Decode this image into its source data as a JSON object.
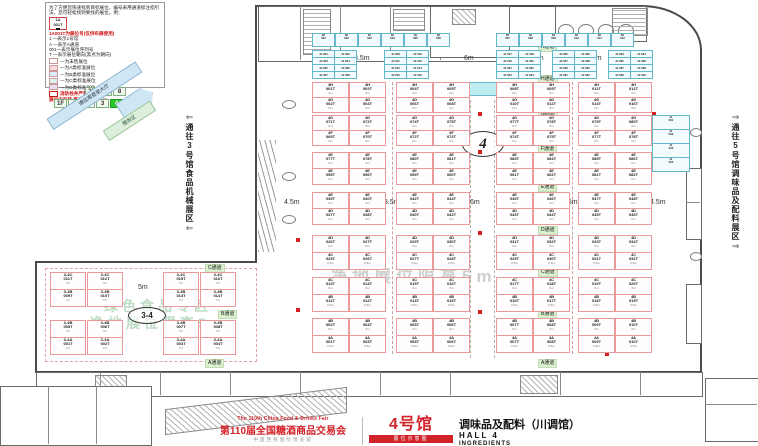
{
  "legend": {
    "intro": "为了方便您快速找到目标展位，编号采用通道标注指引法，您可轻松找到要找的展位。例：",
    "example": {
      "line1": "1A",
      "line2": "001T"
    },
    "red_note": "1A001T为展位号(仅供布展使用)",
    "key_lines": [
      "1 —表示1号馆",
      "A —表示A通道",
      "001—表示展位序列号",
      "T —表示展位朝向(黑点为朝向)"
    ],
    "swatches": [
      {
        "color": "#ffffff",
        "label": "—为未售展位"
      },
      {
        "color": "#f9d9dc",
        "label": "—为A类标准展位"
      },
      {
        "color": "#d9ecf9",
        "label": "—为B类标准展位"
      },
      {
        "color": "#d9f4ee",
        "label": "—为C类标准展位"
      },
      {
        "color": "#e6def2",
        "label": "—为D类标准展位"
      }
    ],
    "warn1": "消防栓井严禁遮挡",
    "warn2": "展位内安装 高度限制为1.5m"
  },
  "floor_selector": {
    "upper": [
      "2F",
      "7",
      "8"
    ],
    "lower": [
      "1F",
      "1",
      "2",
      "3",
      "4",
      "5",
      "6"
    ],
    "active": "4"
  },
  "diagonals": {
    "blue_band": "通往南登录大厅",
    "green_band": "服务区"
  },
  "passages": {
    "left": "通往3号馆食品机械展区",
    "right": "通往5号馆调味品及配料展区"
  },
  "markers": {
    "hall": "4",
    "annex": "3-4"
  },
  "watermarks": {
    "center": "净地展位限高5m",
    "annex_line1": "绿色食品专区",
    "annex_line2": "净地展位限高5m"
  },
  "aisle_labels": [
    {
      "t": "K通道",
      "x": 538,
      "y": 43
    },
    {
      "t": "H通道",
      "x": 538,
      "y": 75
    },
    {
      "t": "G通道",
      "x": 538,
      "y": 110
    },
    {
      "t": "F通道",
      "x": 538,
      "y": 145
    },
    {
      "t": "E通道",
      "x": 538,
      "y": 183
    },
    {
      "t": "D通道",
      "x": 538,
      "y": 226
    },
    {
      "t": "C通道",
      "x": 538,
      "y": 268
    },
    {
      "t": "B通道",
      "x": 538,
      "y": 310
    },
    {
      "t": "A通道",
      "x": 538,
      "y": 359
    },
    {
      "t": "C通道",
      "x": 205,
      "y": 264
    },
    {
      "t": "B通道",
      "x": 218,
      "y": 310
    },
    {
      "t": "A通道",
      "x": 205,
      "y": 359
    }
  ],
  "width_labels": [
    {
      "t": "3.5m",
      "x": 354,
      "y": 55
    },
    {
      "t": "6m",
      "x": 464,
      "y": 55
    },
    {
      "t": "3.5m",
      "x": 528,
      "y": 55
    },
    {
      "t": "3.5m",
      "x": 586,
      "y": 55
    },
    {
      "t": "4.5m",
      "x": 284,
      "y": 199
    },
    {
      "t": "3.5m",
      "x": 384,
      "y": 199
    },
    {
      "t": "6m",
      "x": 470,
      "y": 199
    },
    {
      "t": "3.5m",
      "x": 562,
      "y": 199
    },
    {
      "t": "4.5m",
      "x": 650,
      "y": 199
    },
    {
      "t": "5m",
      "x": 138,
      "y": 284
    }
  ],
  "fire_hydrants": [
    {
      "x": 478,
      "y": 112
    },
    {
      "x": 478,
      "y": 150
    },
    {
      "x": 478,
      "y": 231
    },
    {
      "x": 478,
      "y": 310
    },
    {
      "x": 296,
      "y": 238
    },
    {
      "x": 296,
      "y": 308
    },
    {
      "x": 652,
      "y": 112
    },
    {
      "x": 605,
      "y": 352
    }
  ],
  "cyan_top_row": {
    "prefix": "4K",
    "left": [
      "001",
      "002",
      "003",
      "004",
      "005",
      "006"
    ],
    "right": [
      "007",
      "008",
      "009",
      "010",
      "011",
      "012"
    ]
  },
  "cyan_grid": {
    "prefix": "4J",
    "clusters": [
      [
        "001",
        "002",
        "003",
        "004",
        "005",
        "006",
        "007",
        "008"
      ],
      [
        "009",
        "010",
        "011",
        "012",
        "013",
        "014",
        "015",
        "016"
      ],
      [
        "017",
        "018",
        "019",
        "020",
        "021",
        "022",
        "023",
        "024"
      ],
      [
        "025",
        "026",
        "027",
        "028",
        "029",
        "030",
        "031",
        "032"
      ],
      [
        "033",
        "034",
        "035",
        "036",
        "037",
        "038",
        "039",
        "040"
      ]
    ]
  },
  "right_strip": {
    "prefix": "4L",
    "booths": [
      "001",
      "002",
      "003",
      "004"
    ]
  },
  "main_blocks": [
    {
      "y": 82,
      "rows": [
        {
          "prefix": "4H",
          "h": 14,
          "size": "6m",
          "booths": [
            "001T",
            "002T",
            "004T",
            "005T",
            "008T",
            "009T",
            "011T",
            "012T"
          ]
        },
        {
          "prefix": "4G",
          "h": 14,
          "size": "6m",
          "booths": [
            "002T",
            "004T",
            "006T",
            "008T",
            "010T",
            "012T",
            "014T",
            "016T"
          ]
        }
      ]
    },
    {
      "y": 115,
      "rows": [
        {
          "prefix": "4G",
          "h": 14,
          "size": "6m",
          "booths": [
            "071T",
            "072T",
            "074T",
            "075T",
            "077T",
            "078T",
            "079T",
            "080T"
          ]
        },
        {
          "prefix": "4F",
          "h": 14,
          "size": "6m",
          "booths": [
            "069T",
            "070T",
            "072T",
            "073T",
            "074T",
            "075T",
            "077T",
            "078T"
          ]
        }
      ]
    },
    {
      "y": 152,
      "rows": [
        {
          "prefix": "4E",
          "h": 15,
          "size": "6m",
          "booths": [
            "077T",
            "078T",
            "080T",
            "081T",
            "083T",
            "084T",
            "085T",
            "086T"
          ]
        },
        {
          "prefix": "4E",
          "h": 15,
          "size": "6m",
          "booths": [
            "055T",
            "056T",
            "059T",
            "060T",
            "061T",
            "062T",
            "081T",
            "082T"
          ]
        }
      ]
    },
    {
      "y": 192,
      "rows": [
        {
          "prefix": "4E",
          "h": 15,
          "size": "6m",
          "booths": [
            "039T",
            "040T",
            "042T",
            "044T",
            "045T",
            "046T",
            "047T",
            "048T"
          ]
        },
        {
          "prefix": "4D",
          "h": 15,
          "size": "6m",
          "booths": [
            "037T",
            "038T",
            "040T",
            "042T",
            "043T",
            "044T",
            "045T",
            "046T"
          ]
        }
      ]
    },
    {
      "y": 235,
      "rows": [
        {
          "prefix": "4D",
          "h": 16,
          "size": "6m",
          "booths": [
            "026T",
            "027T",
            "029T",
            "030T",
            "031T",
            "032T",
            "033T",
            "034T"
          ]
        },
        {
          "prefix": "4C",
          "h": 16,
          "size": "6.5m",
          "booths": [
            "025T",
            "026T",
            "027T",
            "028T",
            "029T",
            "030T",
            "031T",
            "032T"
          ]
        }
      ]
    },
    {
      "y": 277,
      "rows": [
        {
          "prefix": "4C",
          "h": 16,
          "size": "6m",
          "booths": [
            "013T",
            "014T",
            "015T",
            "016T",
            "017T",
            "018T",
            "019T",
            "020T"
          ]
        },
        {
          "prefix": "4B",
          "h": 16,
          "size": "6.5m",
          "booths": [
            "011T",
            "012T",
            "013T",
            "015T",
            "016T",
            "017T",
            "018T",
            "019T"
          ]
        }
      ]
    },
    {
      "y": 318,
      "rows": [
        {
          "prefix": "4B",
          "h": 16,
          "size": "6m",
          "booths": [
            "002T",
            "004T",
            "005T",
            "006T",
            "007T",
            "008T",
            "009T",
            "010T"
          ]
        },
        {
          "prefix": "4A",
          "h": 16,
          "size": "6.5m",
          "booths": [
            "001T",
            "003T",
            "005T",
            "006T",
            "007T",
            "008T",
            "009T",
            "010T"
          ]
        }
      ]
    }
  ],
  "annex_blocks": [
    {
      "y": 272,
      "rows": [
        {
          "prefix": "3-4C",
          "h": 16,
          "size": "7m",
          "booths": [
            "011T",
            "012T",
            "015T",
            "016T"
          ]
        },
        {
          "prefix": "3-4B",
          "h": 16,
          "size": "7m",
          "booths": [
            "009T",
            "010T",
            "013T",
            "014T"
          ]
        }
      ]
    },
    {
      "y": 320,
      "rows": [
        {
          "prefix": "3-4B",
          "h": 16,
          "size": "7m",
          "booths": [
            "005T",
            "006T",
            "007T",
            "008T"
          ]
        },
        {
          "prefix": "3-4A",
          "h": 16,
          "size": "7m",
          "booths": [
            "001T",
            "002T",
            "003T",
            "004T"
          ]
        }
      ]
    }
  ],
  "title_block": {
    "fair_en": "The 110th China Food & Drinks Fair",
    "fair_cn": "第110届全国糖酒商品交易会",
    "venue": "中国西部国际博览城",
    "hall_big": "4号馆",
    "badge": "展位示意图",
    "hall_cn": "调味品及配料（川调馆）",
    "hall_en": "HALL 4",
    "hall_sub": "INGREDIENTS"
  }
}
